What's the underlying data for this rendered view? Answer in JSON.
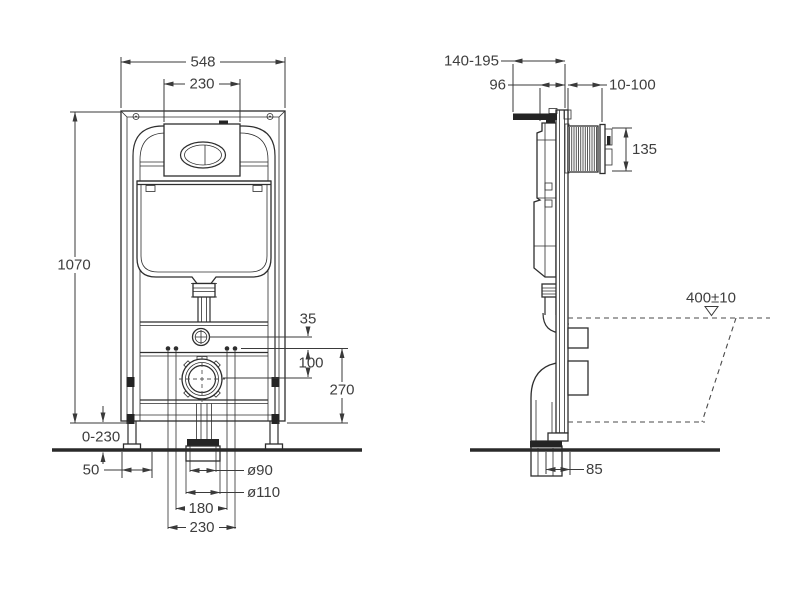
{
  "front": {
    "frame_width": "548",
    "plate_width": "230",
    "frame_height": "1070",
    "leg_adjust": "0-230",
    "leg_offset": "50",
    "inlet_offset": "35",
    "inlet_to_bolts": "100",
    "outlet_center": "270",
    "outlet_d90": "ø90",
    "outlet_d110": "ø110",
    "bolt_spacing_inner": "180",
    "bolt_spacing_outer": "230"
  },
  "side": {
    "depth_range": "140-195",
    "cistern_depth": "96",
    "finish_range": "10-100",
    "plate_cutout": "135",
    "bowl_height": "400±10",
    "outlet_offset": "85"
  },
  "colors": {
    "line": "#2e2e2e",
    "text": "#3e3e3e",
    "background": "#ffffff"
  }
}
